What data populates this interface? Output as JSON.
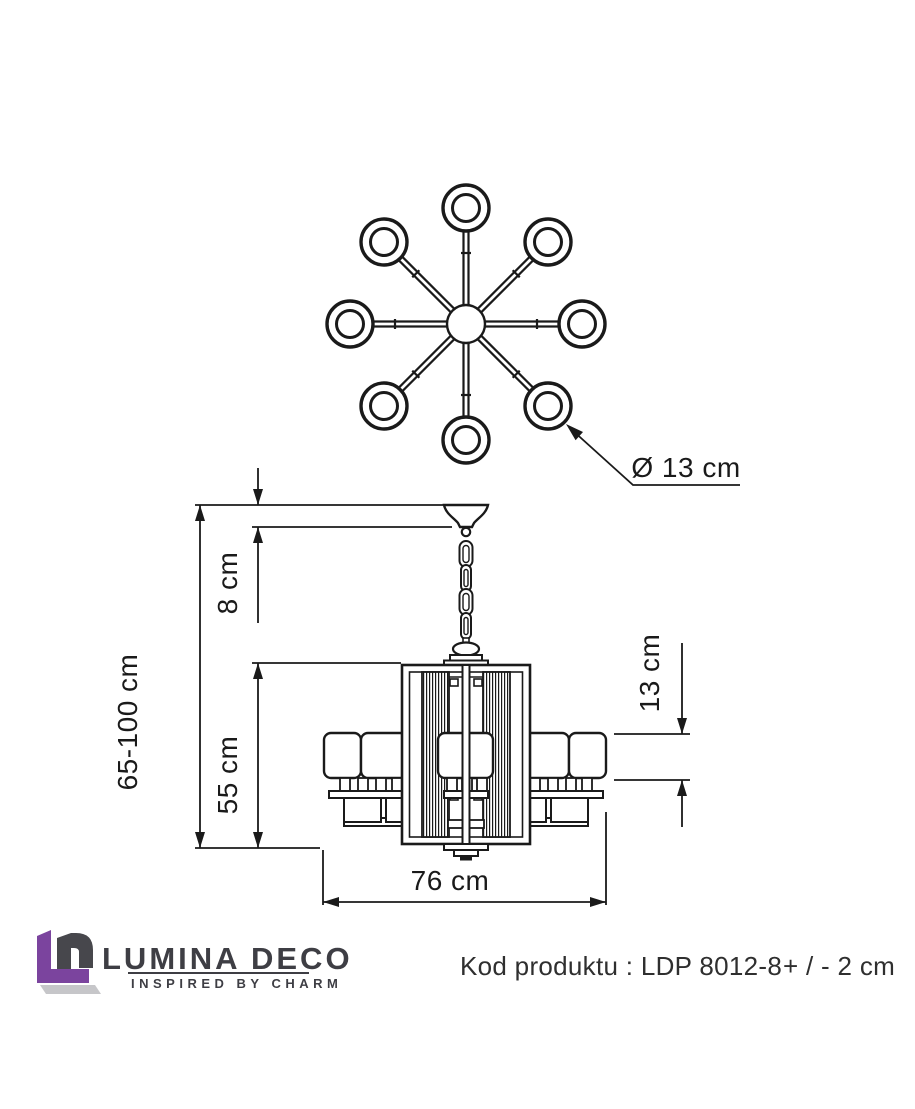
{
  "top_view": {
    "arms_count": 8
  },
  "dimensions": {
    "shade_diameter": "Ø 13 cm",
    "total_height": "65-100 cm",
    "canopy_height": "8 cm",
    "body_height": "55 cm",
    "shade_height": "13 cm",
    "width": "76 cm"
  },
  "footer": {
    "brand_name": "LUMINA DECO",
    "brand_tagline": "INSPIRED BY CHARM",
    "product_code": "Kod produktu : LDP 8012-8",
    "tolerance": "+ / - 2 cm"
  },
  "colors": {
    "line": "#1a1a1a",
    "brand_purple": "#7b449e",
    "brand_gray": "#47474c",
    "shadow_gray": "#c6c6c9"
  }
}
